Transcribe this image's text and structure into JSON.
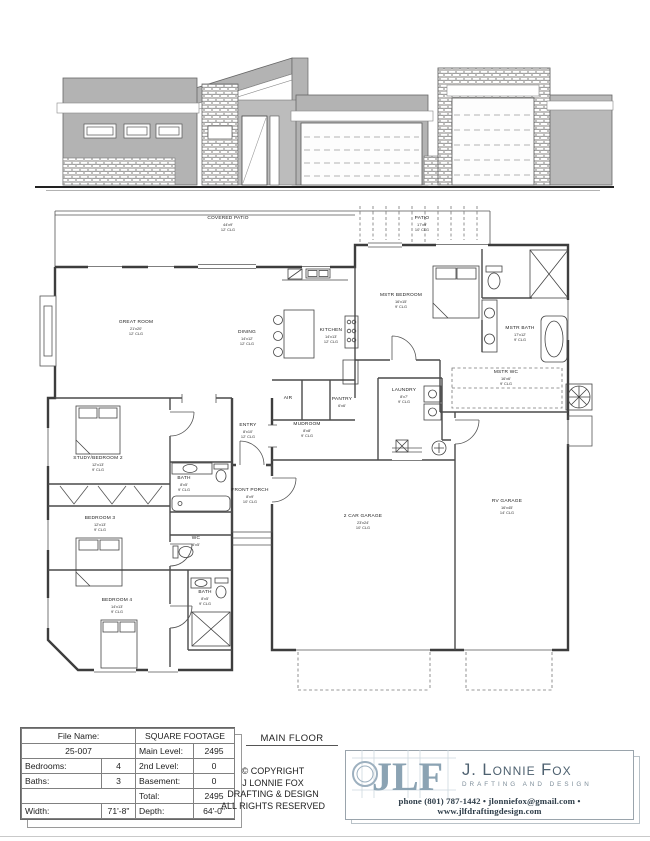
{
  "plan": {
    "title": "MAIN FLOOR",
    "rooms": [
      {
        "n": "COVERED PATIO",
        "s": "44'x9'",
        "c": "12' CLG"
      },
      {
        "n": "PATIO",
        "s": "17'x9'",
        "c": "10' CLG"
      },
      {
        "n": "GREAT ROOM",
        "s": "21'x20'",
        "c": "12' CLG"
      },
      {
        "n": "DINING",
        "s": "14'x12'",
        "c": "12' CLG"
      },
      {
        "n": "KITCHEN",
        "s": "14'x13'",
        "c": "12' CLG"
      },
      {
        "n": "PANTRY",
        "s": "6'x6'"
      },
      {
        "n": "AIR"
      },
      {
        "n": "ENTRY",
        "s": "8'x10'",
        "c": "12' CLG"
      },
      {
        "n": "FRONT PORCH",
        "s": "8'x9'",
        "c": "10' CLG"
      },
      {
        "n": "MUDROOM",
        "s": "8'x8'",
        "c": "9' CLG"
      },
      {
        "n": "LAUNDRY",
        "s": "8'x7'",
        "c": "9' CLG"
      },
      {
        "n": "MSTR BEDROOM",
        "s": "16'x15'",
        "c": "9' CLG"
      },
      {
        "n": "MSTR BATH",
        "s": "17'x12'",
        "c": "9' CLG"
      },
      {
        "n": "MSTR WC",
        "s": "16'x6'",
        "c": "9' CLG"
      },
      {
        "n": "BATH",
        "s": "8'x5'",
        "c": "9' CLG"
      },
      {
        "n": "WC",
        "s": "5'x5'"
      },
      {
        "n": "BATH",
        "s": "8'x5'",
        "c": "9' CLG"
      },
      {
        "n": "STUDY/BEDROOM 2",
        "s": "12'x13'",
        "c": "9' CLG"
      },
      {
        "n": "BEDROOM 3",
        "s": "12'x13'",
        "c": "9' CLG"
      },
      {
        "n": "BEDROOM 4",
        "s": "14'x13'",
        "c": "9' CLG"
      },
      {
        "n": "2 CAR GARAGE",
        "s": "23'x24'",
        "c": "10' CLG"
      },
      {
        "n": "RV GARAGE",
        "s": "16'x45'",
        "c": "14' CLG"
      }
    ]
  },
  "titleblock": {
    "file_name_label": "File Name:",
    "file_number": "25-007",
    "sqft_header": "SQUARE FOOTAGE",
    "bedrooms_label": "Bedrooms:",
    "bedrooms": "4",
    "baths_label": "Baths:",
    "baths": "3",
    "main_level_label": "Main Level:",
    "main_level": "2495",
    "second_level_label": "2nd Level:",
    "second_level": "0",
    "basement_label": "Basement:",
    "basement": "0",
    "total_label": "Total:",
    "total": "2495",
    "width_label": "Width:",
    "width": "71'-8\"",
    "depth_label": "Depth:",
    "depth": "64'-0\""
  },
  "copyright": {
    "l1": "© COPYRIGHT",
    "l2": "J LONNIE FOX",
    "l3": "DRAFTING & DESIGN",
    "l4": "ALL RIGHTS RESERVED"
  },
  "logo": {
    "monogram": "JLF",
    "company": "J. Lonnie Fox",
    "tagline": "DRAFTING AND DESIGN",
    "contact": "phone (801) 787-1442 • jlonniefox@gmail.com • www.jlfdraftingdesign.com"
  },
  "colors": {
    "wall_gray": "#b3b3b3",
    "logo_blue": "#8ba3b3",
    "ink": "#222222"
  }
}
